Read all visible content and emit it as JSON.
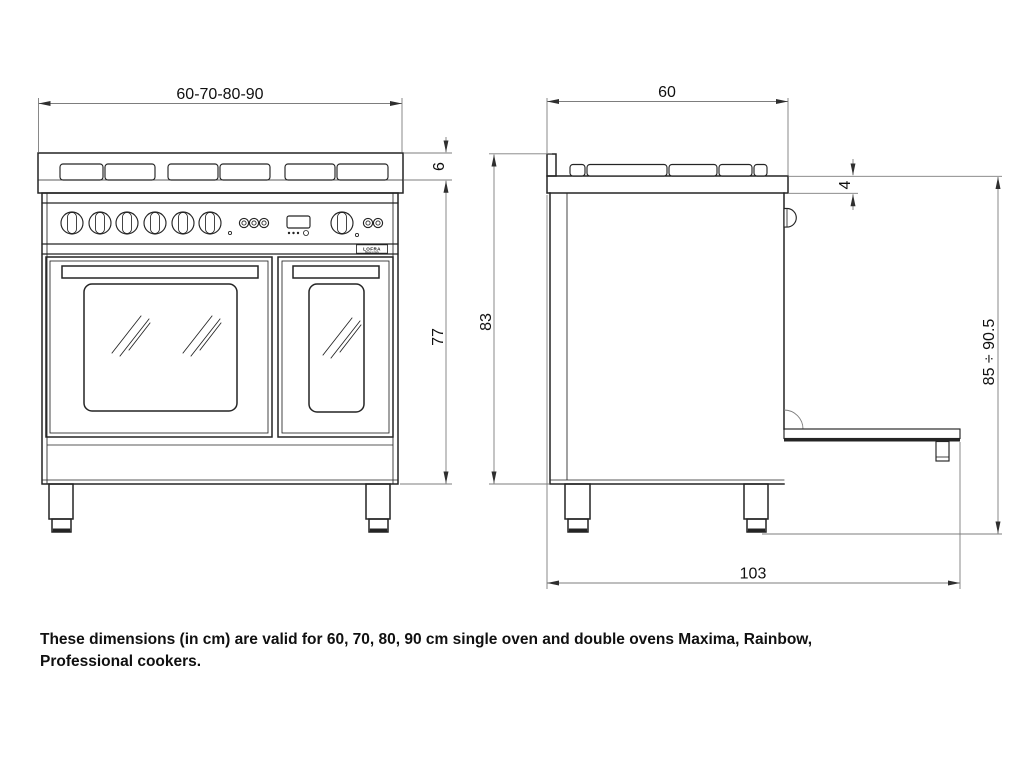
{
  "colors": {
    "outline": "#242424",
    "dimension": "#7d7d7d",
    "text": "#101010",
    "background": "#ffffff"
  },
  "brand": {
    "name": "LOFRA",
    "tagline": "Made in Italy"
  },
  "front_view": {
    "width": "60-70-80-90",
    "hob_edge_height": "6",
    "body_height": "77"
  },
  "side_view": {
    "depth": "60",
    "pan_support_height": "4",
    "rear_height": "83",
    "worktop_height_range": "85 ÷ 90.5",
    "depth_door_open": "103"
  },
  "caption": {
    "line1": "These dimensions (in cm) are valid for 60, 70, 80, 90 cm single oven and double ovens Maxima, Rainbow,",
    "line2": "Professional cookers."
  }
}
